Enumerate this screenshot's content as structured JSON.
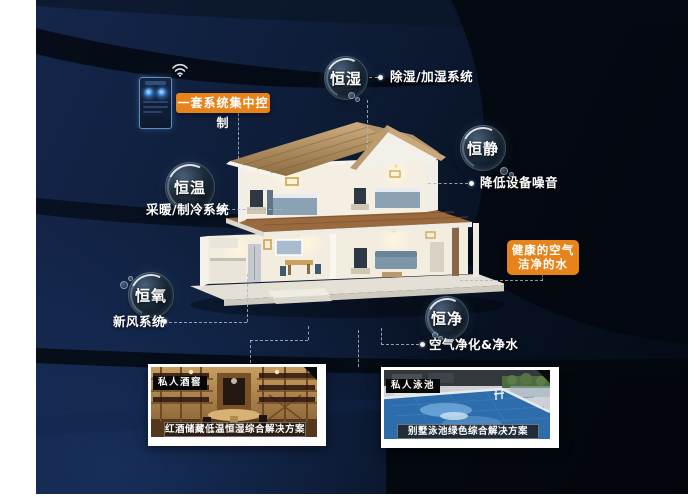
{
  "scene": {
    "control_badge": "一套系统集中控制",
    "bubbles": [
      {
        "name": "恒湿",
        "desc": "除湿/加湿系统"
      },
      {
        "name": "恒静",
        "desc": "降低设备噪音"
      },
      {
        "name": "恒温",
        "desc": "采暖/制冷系统"
      },
      {
        "name": "恒氧",
        "desc": "新风系统"
      },
      {
        "name": "恒净",
        "desc": "空气净化&净水"
      }
    ],
    "callout": {
      "line1": "健康的空气",
      "line2": "洁净的水"
    },
    "photos": [
      {
        "tag": "私人酒窖",
        "caption": "红酒储藏低温恒湿综合解决方案"
      },
      {
        "tag": "私人泳池",
        "caption": "别墅泳池绿色综合解决方案"
      }
    ],
    "colors": {
      "accent_orange": "#e8831c",
      "background_navy": "#0e1d38",
      "text": "#ffffff"
    },
    "icons": {
      "wifi": "wifi-icon"
    }
  }
}
